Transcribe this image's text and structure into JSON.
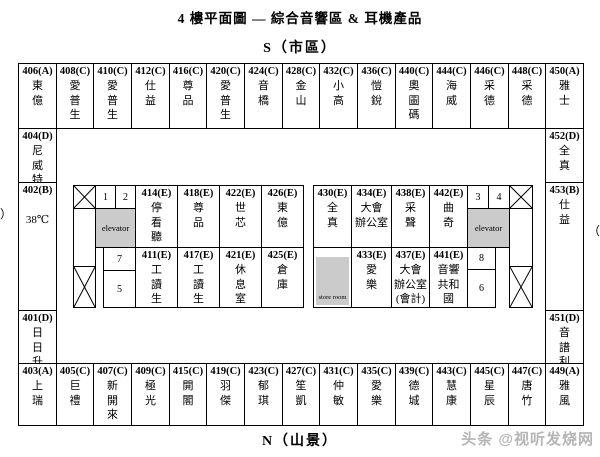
{
  "title": "4 樓平面圖 — 綜合音響區 & 耳機產品",
  "orientation": {
    "top": "S（市區）",
    "bottom": "N（山景）",
    "left_cropped_mark": "）",
    "right_cropped_mark": "（"
  },
  "watermark": "头条 @视听发烧网",
  "labels": {
    "elevator": "elevator",
    "store_room": "store room"
  },
  "colors": {
    "background": "#ffffff",
    "border": "#000000",
    "shaded_fill": "#cbcbcb",
    "watermark_gray": "#b5b5b5"
  },
  "map": {
    "top_row": [
      {
        "number": "406(A)",
        "name": "東\n億"
      },
      {
        "number": "408(C)",
        "name": "愛\n普\n生"
      },
      {
        "number": "410(C)",
        "name": "愛\n普\n生"
      },
      {
        "number": "412(C)",
        "name": "仕\n益"
      },
      {
        "number": "416(C)",
        "name": "尊\n品"
      },
      {
        "number": "420(C)",
        "name": "愛\n普\n生"
      },
      {
        "number": "424(C)",
        "name": "音\n橋"
      },
      {
        "number": "428(C)",
        "name": "金\n山"
      },
      {
        "number": "432(C)",
        "name": "小\n高"
      },
      {
        "number": "436(C)",
        "name": "愷\n銳"
      },
      {
        "number": "440(C)",
        "name": "奧\n圖\n碼"
      },
      {
        "number": "444(C)",
        "name": "海\n威"
      },
      {
        "number": "446(C)",
        "name": "采\n德"
      },
      {
        "number": "448(C)",
        "name": "采\n德"
      },
      {
        "number": "450(A)",
        "name": "雅\n士"
      }
    ],
    "left_column": [
      {
        "number": "404(D)",
        "name": "尼\n威\n特"
      },
      {
        "number": "402(B)",
        "name": "\n38℃"
      },
      {
        "number": "401(D)",
        "name": "日\n日\n升"
      }
    ],
    "right_column": [
      {
        "number": "452(D)",
        "name": "全\n真"
      },
      {
        "number": "453(B)",
        "name": "仕\n益"
      },
      {
        "number": "451(D)",
        "name": "音\n譜\n利"
      }
    ],
    "bottom_row": [
      {
        "number": "403(A)",
        "name": "上\n瑞"
      },
      {
        "number": "405(C)",
        "name": "巨\n禮"
      },
      {
        "number": "407(C)",
        "name": "新\n開\n來"
      },
      {
        "number": "409(C)",
        "name": "極\n光"
      },
      {
        "number": "415(C)",
        "name": "開\n閣"
      },
      {
        "number": "419(C)",
        "name": "羽\n傑"
      },
      {
        "number": "423(C)",
        "name": "郁\n琪"
      },
      {
        "number": "427(C)",
        "name": "笙\n凱"
      },
      {
        "number": "431(C)",
        "name": "仲\n敏"
      },
      {
        "number": "435(C)",
        "name": "愛\n樂"
      },
      {
        "number": "439(C)",
        "name": "德\n城"
      },
      {
        "number": "443(C)",
        "name": "慧\n康"
      },
      {
        "number": "445(C)",
        "name": "星\n辰"
      },
      {
        "number": "447(C)",
        "name": "唐\n竹"
      },
      {
        "number": "449(A)",
        "name": "雅\n風"
      }
    ],
    "inner_left": {
      "shops_top": [
        {
          "number": "414(E)",
          "name": "停\n看\n聽"
        },
        {
          "number": "418(E)",
          "name": "尊\n品"
        },
        {
          "number": "422(E)",
          "name": "世\n芯"
        },
        {
          "number": "426(E)",
          "name": "東\n億"
        }
      ],
      "shops_bottom": [
        {
          "number": "411(E)",
          "name": "工\n讀\n生"
        },
        {
          "number": "417(E)",
          "name": "工\n讀\n生"
        },
        {
          "number": "421(E)",
          "name": "休\n息\n室"
        },
        {
          "number": "425(E)",
          "name": "倉\n庫"
        }
      ],
      "small_cells": [
        "1",
        "2",
        "7",
        "5"
      ]
    },
    "inner_right": {
      "shops_top": [
        {
          "number": "430(E)",
          "name": "全\n真"
        },
        {
          "number": "434(E)",
          "name": "大會\n辦公室"
        },
        {
          "number": "438(E)",
          "name": "采\n聲"
        },
        {
          "number": "442(E)",
          "name": "曲\n奇"
        }
      ],
      "shops_bottom": [
        {
          "number": "433(E)",
          "name": "愛\n樂"
        },
        {
          "number": "437(E)",
          "name": "大會\n辦公室\n(會計)"
        },
        {
          "number": "441(E)",
          "name": "音響\n共和\n國"
        }
      ],
      "small_cells": [
        "3",
        "4",
        "8",
        "6"
      ]
    }
  }
}
